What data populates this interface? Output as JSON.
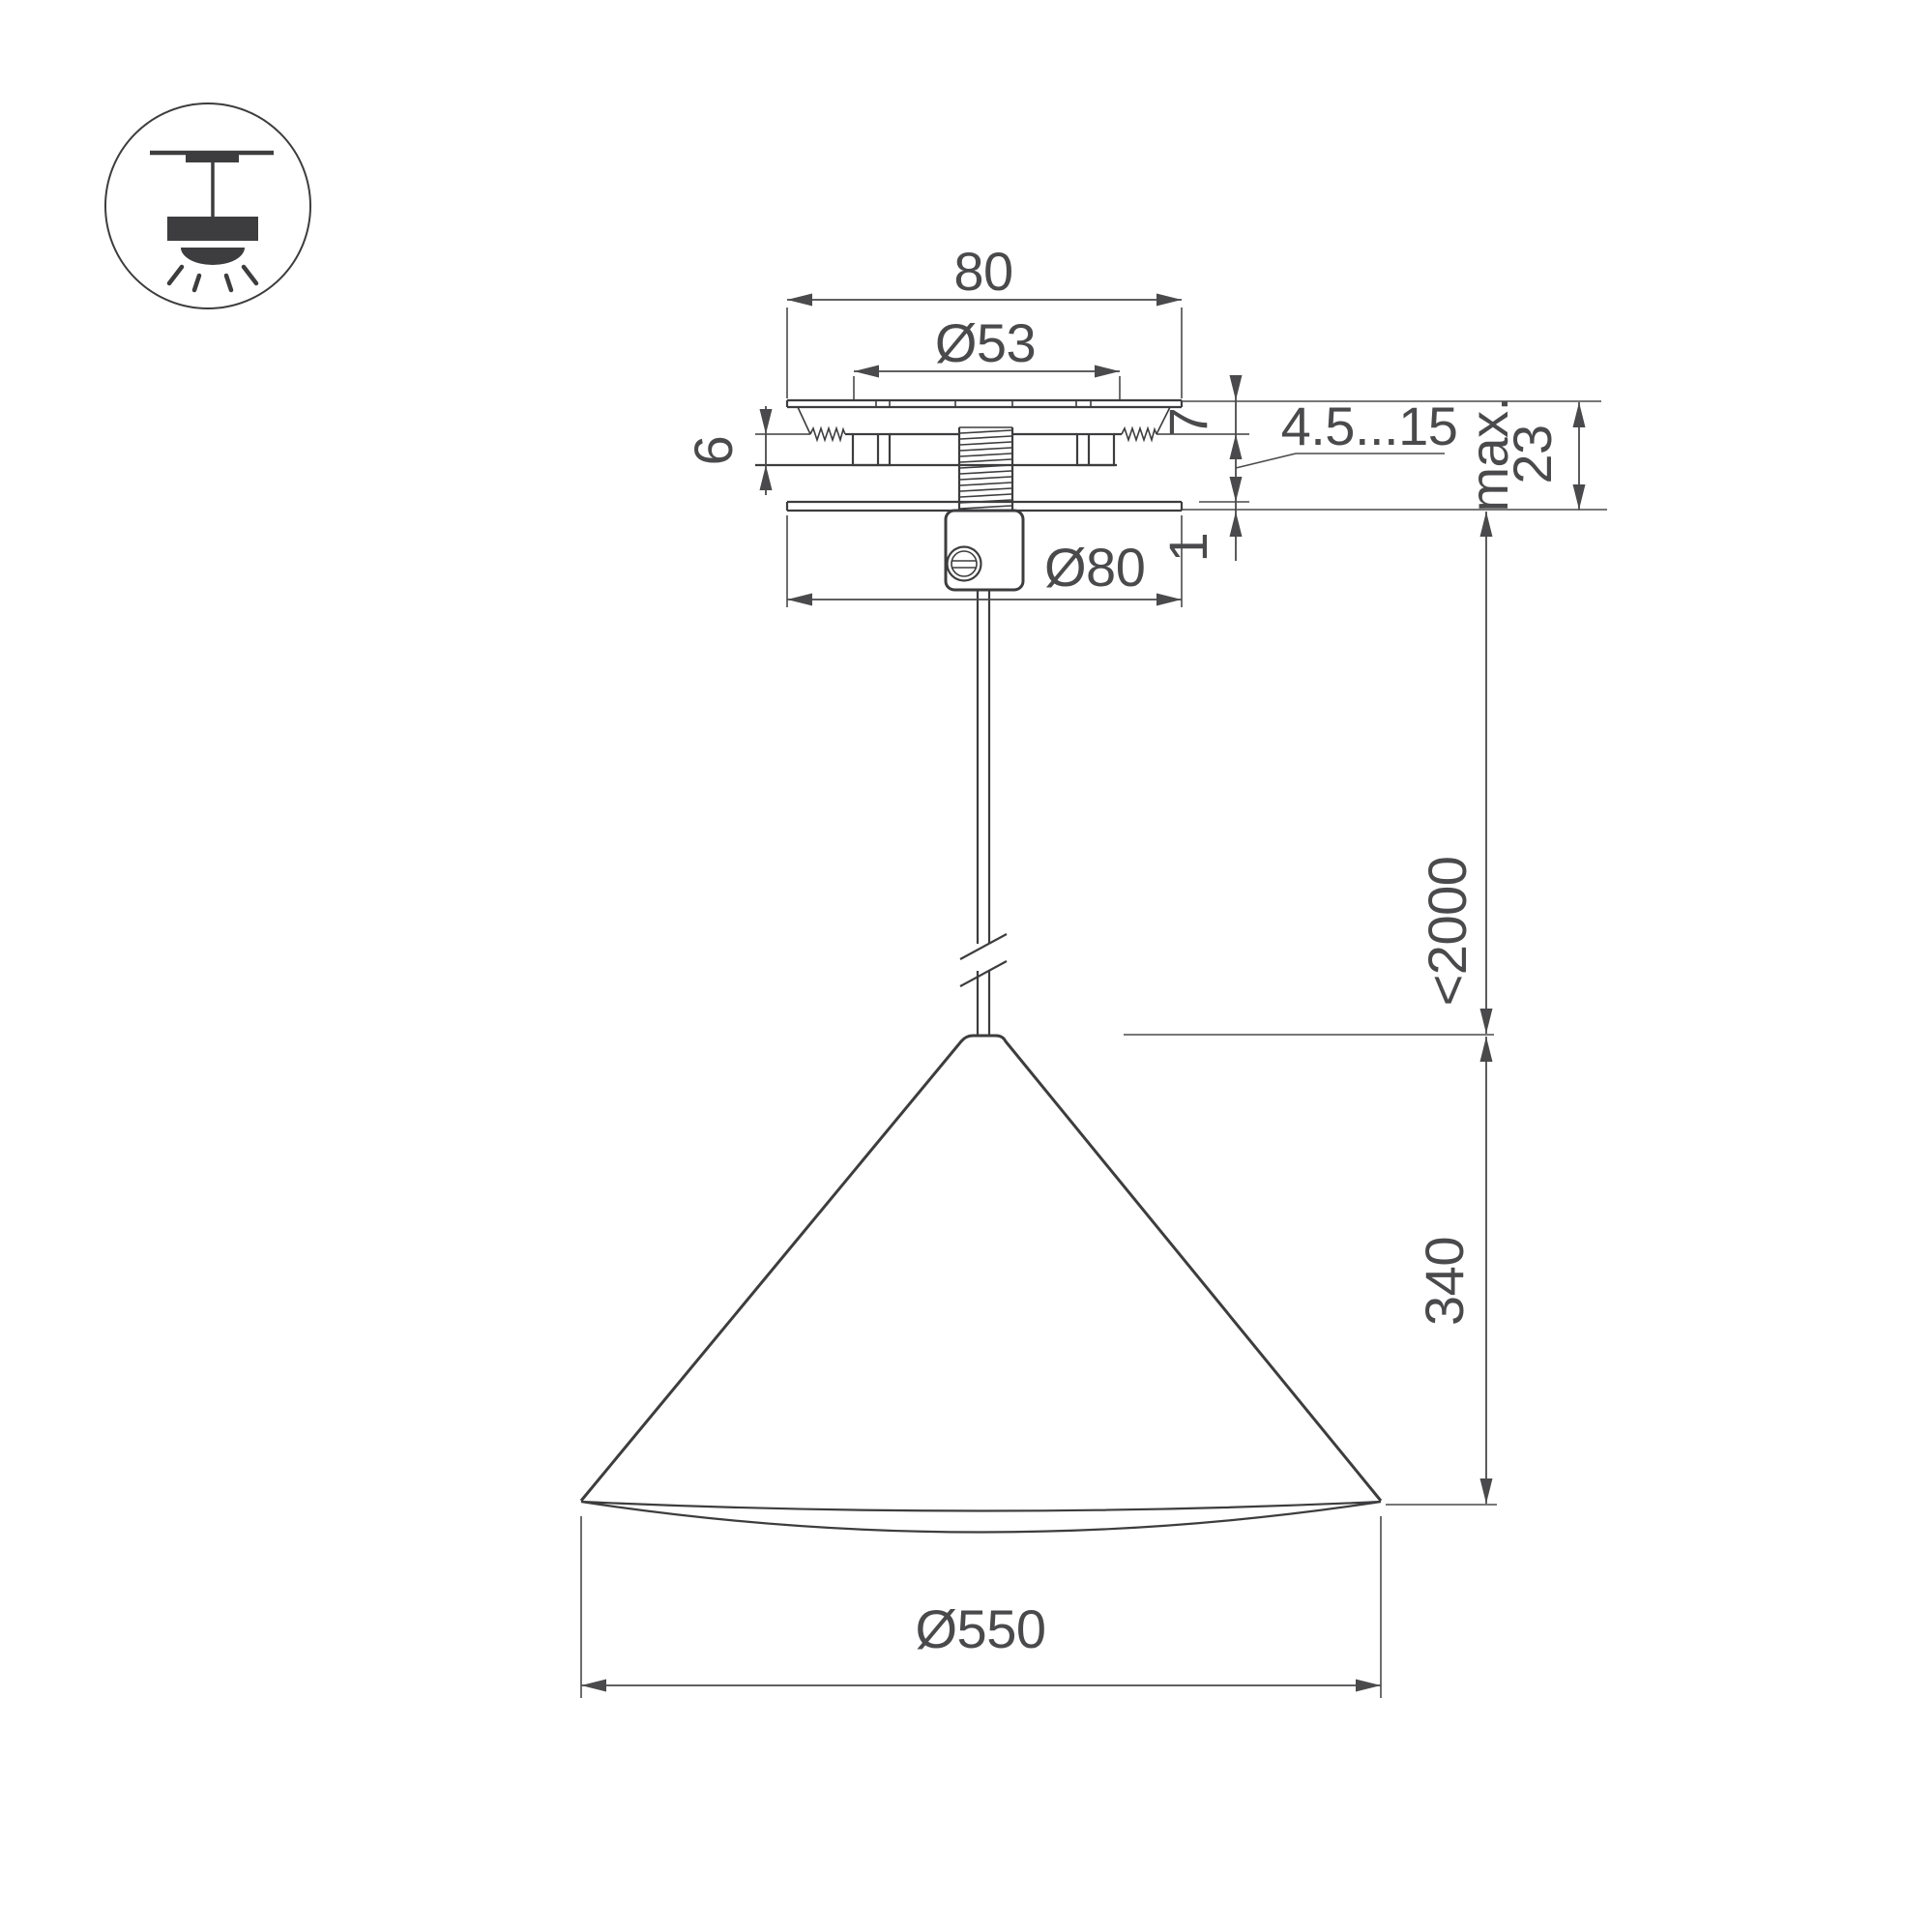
{
  "drawing": {
    "background": "#ffffff",
    "line_color": "#3d3d3f",
    "dim_color": "#4a4a4c",
    "mount_type_icon": "pendant-ceiling-mount-icon",
    "dims": {
      "canopy_top_width": "80",
      "canopy_hole_dia": "Ø53",
      "plate_offset": "7",
      "spring_clip_height": "6",
      "ceiling_thickness_range": "4.5...15",
      "recess_max_label": "max.",
      "recess_max_value": "23",
      "base_plate_thickness": "1",
      "canopy_dia": "Ø80",
      "wire_length": "<2000",
      "shade_height": "340",
      "shade_dia": "Ø550"
    }
  }
}
